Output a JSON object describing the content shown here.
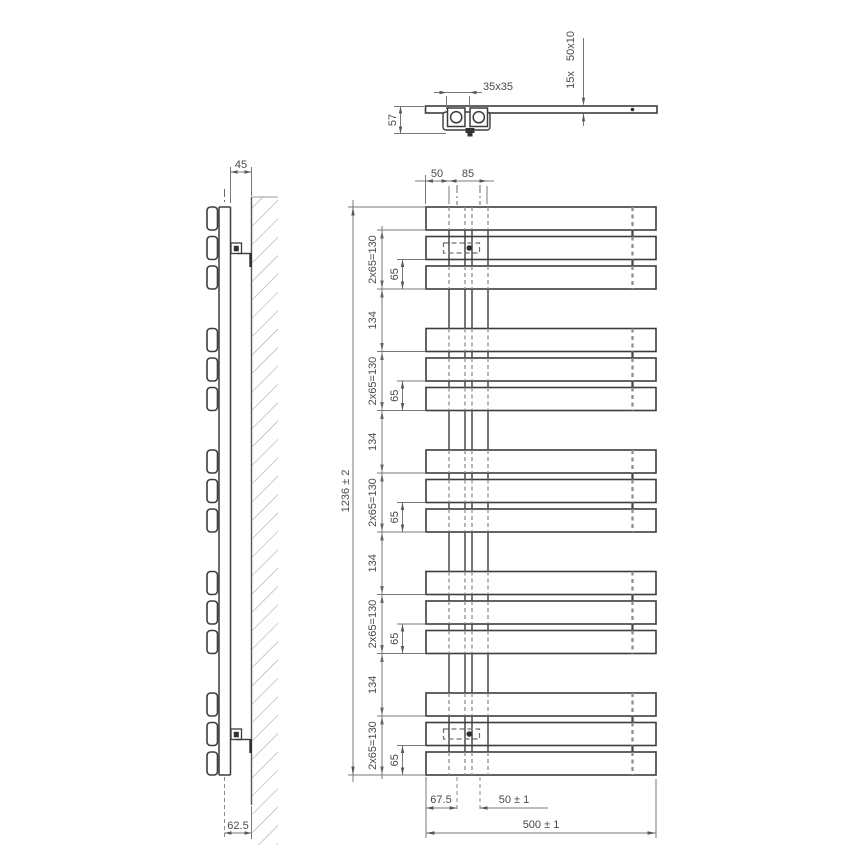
{
  "colors": {
    "object_line": "#3d3d3d",
    "dimension_line": "#787878",
    "hidden_line": "#8f8f8f",
    "text": "#4a4a4a",
    "background": "#ffffff"
  },
  "top_view": {
    "bracket_plate_dim": "35x35",
    "bracket_depth_dim": "57",
    "bar_count_label": "15x",
    "bar_profile_label": "50x10"
  },
  "side_view": {
    "wall_gap_dim": "45",
    "mount_depth_dim": "62.5"
  },
  "front_view": {
    "edge_to_tube_dim": "50",
    "tube_span_dim": "85",
    "height_dim": "1236 ± 2",
    "group_height_dim": "2x65=130",
    "bar_step_dim": "65",
    "group_gap_dim": "134",
    "bottom_edge_dim": "67.5",
    "tube_pitch_dim": "50 ± 1",
    "width_dim": "500 ± 1"
  }
}
